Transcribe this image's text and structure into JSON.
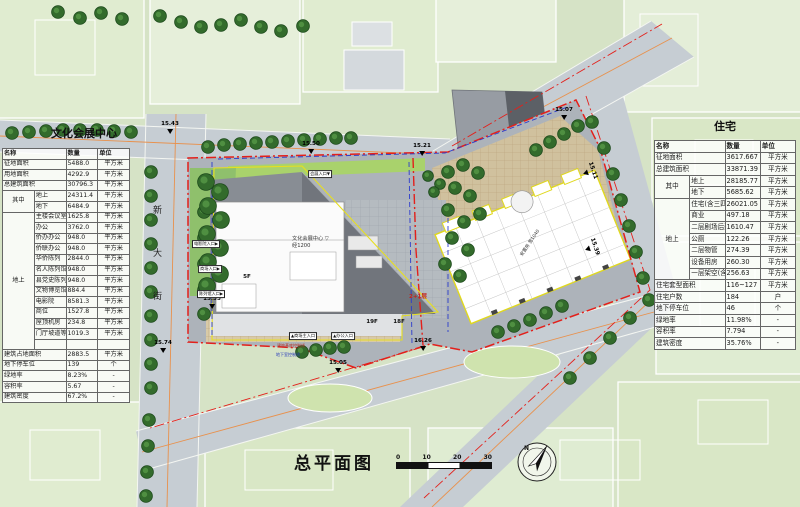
{
  "page_title": "总平面图",
  "scale_bar": {
    "ticks": [
      "0",
      "10",
      "20",
      "30"
    ]
  },
  "compass": {
    "label": "N"
  },
  "tables": {
    "culture": {
      "title": "文化会展中心",
      "headers": [
        "名称",
        "数量",
        "单位"
      ],
      "rows": [
        {
          "g": "",
          "name": "征地面积",
          "value": "5488.0",
          "unit": "平方米"
        },
        {
          "g": "",
          "name": "用地面积",
          "value": "4292.9",
          "unit": "平方米"
        },
        {
          "g": "",
          "name": "总建筑面积",
          "value": "30796.3",
          "unit": "平方米"
        },
        {
          "g": "其中",
          "name": "地上",
          "value": "24311.4",
          "unit": "平方米"
        },
        {
          "g": "其中",
          "name": "地下",
          "value": "6484.9",
          "unit": "平方米"
        },
        {
          "g": "地上",
          "name": "主楼会议室",
          "value": "1625.8",
          "unit": "平方米"
        },
        {
          "g": "地上",
          "name": "办公",
          "value": "3762.0",
          "unit": "平方米"
        },
        {
          "g": "地上",
          "name": "侨办办公",
          "value": "948.0",
          "unit": "平方米"
        },
        {
          "g": "地上",
          "name": "侨联办公",
          "value": "948.0",
          "unit": "平方米"
        },
        {
          "g": "地上",
          "name": "华侨陈列",
          "value": "2844.0",
          "unit": "平方米"
        },
        {
          "g": "地上",
          "name": "名人陈列馆",
          "value": "948.0",
          "unit": "平方米"
        },
        {
          "g": "地上",
          "name": "县党史陈列",
          "value": "948.0",
          "unit": "平方米"
        },
        {
          "g": "地上",
          "name": "文物博览馆",
          "value": "884.4",
          "unit": "平方米"
        },
        {
          "g": "地上",
          "name": "电影院",
          "value": "8581.3",
          "unit": "平方米"
        },
        {
          "g": "地上",
          "name": "商位",
          "value": "1527.8",
          "unit": "平方米"
        },
        {
          "g": "地上",
          "name": "屋顶机房",
          "value": "234.8",
          "unit": "平方米"
        },
        {
          "g": "地上",
          "name": "门厅坡道等",
          "value": "1019.3",
          "unit": "平方米"
        },
        {
          "g": "地上",
          "name": "",
          "value": "",
          "unit": ""
        },
        {
          "g": "",
          "name": "建筑占地面积",
          "value": "2883.5",
          "unit": "平方米"
        },
        {
          "g": "",
          "name": "地下停车位",
          "value": "139",
          "unit": "个"
        },
        {
          "g": "",
          "name": "绿地率",
          "value": "8.23%",
          "unit": "-"
        },
        {
          "g": "",
          "name": "容积率",
          "value": "5.67",
          "unit": "-"
        },
        {
          "g": "",
          "name": "建筑密度",
          "value": "67.2%",
          "unit": "-"
        }
      ]
    },
    "residential": {
      "title": "住宅",
      "headers": [
        "名称",
        "数量",
        "单位"
      ],
      "rows": [
        {
          "g": "",
          "name": "征地面积",
          "value": "3617.667",
          "unit": "平方米"
        },
        {
          "g": "",
          "name": "总建筑面积",
          "value": "33871.39",
          "unit": "平方米"
        },
        {
          "g": "其中",
          "name": "地上",
          "value": "28185.77",
          "unit": "平方米"
        },
        {
          "g": "其中",
          "name": "地下",
          "value": "5685.62",
          "unit": "平方米"
        },
        {
          "g": "地上",
          "name": "住宅(含三四层)",
          "value": "26021.05",
          "unit": "平方米"
        },
        {
          "g": "地上",
          "name": "商业",
          "value": "497.18",
          "unit": "平方米"
        },
        {
          "g": "地上",
          "name": "二层剧场后勤",
          "value": "1610.47",
          "unit": "平方米"
        },
        {
          "g": "地上",
          "name": "公厕",
          "value": "122.26",
          "unit": "平方米"
        },
        {
          "g": "地上",
          "name": "二层物管",
          "value": "274.39",
          "unit": "平方米"
        },
        {
          "g": "地上",
          "name": "设备用房",
          "value": "260.30",
          "unit": "平方米"
        },
        {
          "g": "地上",
          "name": "一层架空(含坡道)",
          "value": "256.63",
          "unit": "平方米"
        },
        {
          "g": "",
          "name": "住宅套型面积",
          "value": "116~127",
          "unit": "平方米"
        },
        {
          "g": "",
          "name": "住宅户数",
          "value": "184",
          "unit": "户"
        },
        {
          "g": "",
          "name": "地下停车位",
          "value": "46",
          "unit": "个"
        },
        {
          "g": "",
          "name": "绿地率",
          "value": "11.98%",
          "unit": "-"
        },
        {
          "g": "",
          "name": "容积率",
          "value": "7.794",
          "unit": "-"
        },
        {
          "g": "",
          "name": "建筑密度",
          "value": "35.76%",
          "unit": "-"
        }
      ]
    }
  },
  "plan": {
    "street_name": "新大街",
    "site_label": {
      "line1": "文化会展中心",
      "mark": "▽",
      "line2": "经1200"
    },
    "entrances": {
      "exhibition": "会展入口",
      "cinema": "电影院入口",
      "mall": "商场入口",
      "gallery": "陈列馆入口",
      "mall_main": "商场主入口",
      "office": "办公入口"
    },
    "floor_labels": {
      "f5": "5F",
      "f19": "19F",
      "f18": "18F",
      "f2p1": "2+1层"
    },
    "annotations": {
      "building_line": "建筑基底控制线",
      "basement_line": "地下室控制线",
      "resettle": "安置房 宽1040"
    },
    "elevations": {
      "e1": "15.43",
      "e2": "15.50",
      "e3": "15.21",
      "e4": "15.07",
      "e5": "15.74",
      "e6": "15.05",
      "e7": "16.26",
      "e8": "15.11",
      "e9": "15.39",
      "e10": "15.55"
    }
  },
  "colors": {
    "boundary_red": "#e3201b",
    "outline_yellow": "#e7df20",
    "guide_blue": "#2c3ccc",
    "road_gray": "#c6cdd3",
    "parcel_green": "#dcead0",
    "tree_green": "#336b2c"
  }
}
